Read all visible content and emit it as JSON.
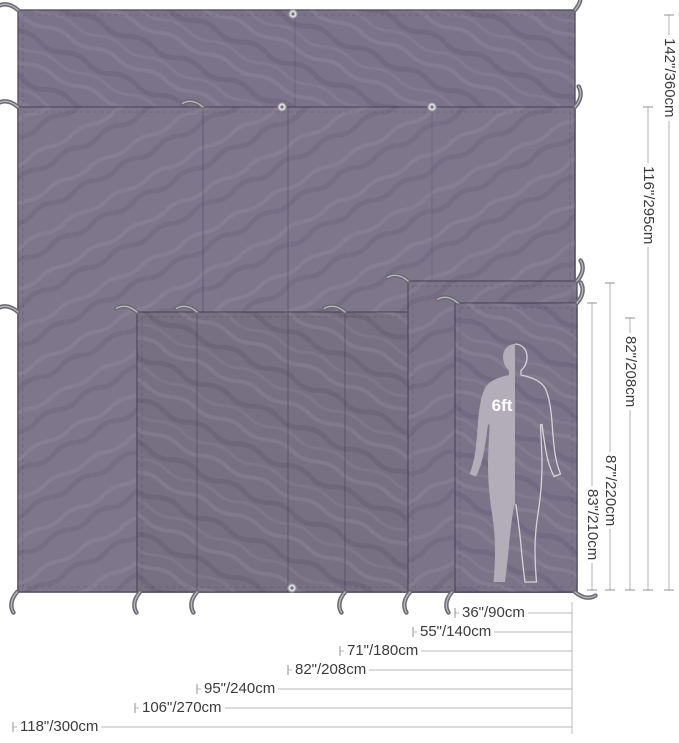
{
  "diagram": {
    "type": "tarp-size-comparison",
    "scale_figure": {
      "label": "6ft"
    },
    "height_dimensions": [
      {
        "label": "142\"/360cm"
      },
      {
        "label": "116\"/295cm"
      },
      {
        "label": "82\"/208cm"
      },
      {
        "label": "87\"/220cm"
      },
      {
        "label": "83\"/210cm"
      }
    ],
    "width_dimensions": [
      {
        "label": "36\"/90cm"
      },
      {
        "label": "55\"/140cm"
      },
      {
        "label": "71\"/180cm"
      },
      {
        "label": "82\"/208cm"
      },
      {
        "label": "95\"/240cm"
      },
      {
        "label": "106\"/270cm"
      },
      {
        "label": "118\"/300cm"
      }
    ],
    "colors": {
      "tarp_fabric": "#7b7389",
      "tarp_edge": "#564f63",
      "dimension_line": "#b8b8b8",
      "label_text": "#3b3b3b",
      "figure_fill": "#b2adb8",
      "background": "#ffffff"
    }
  }
}
